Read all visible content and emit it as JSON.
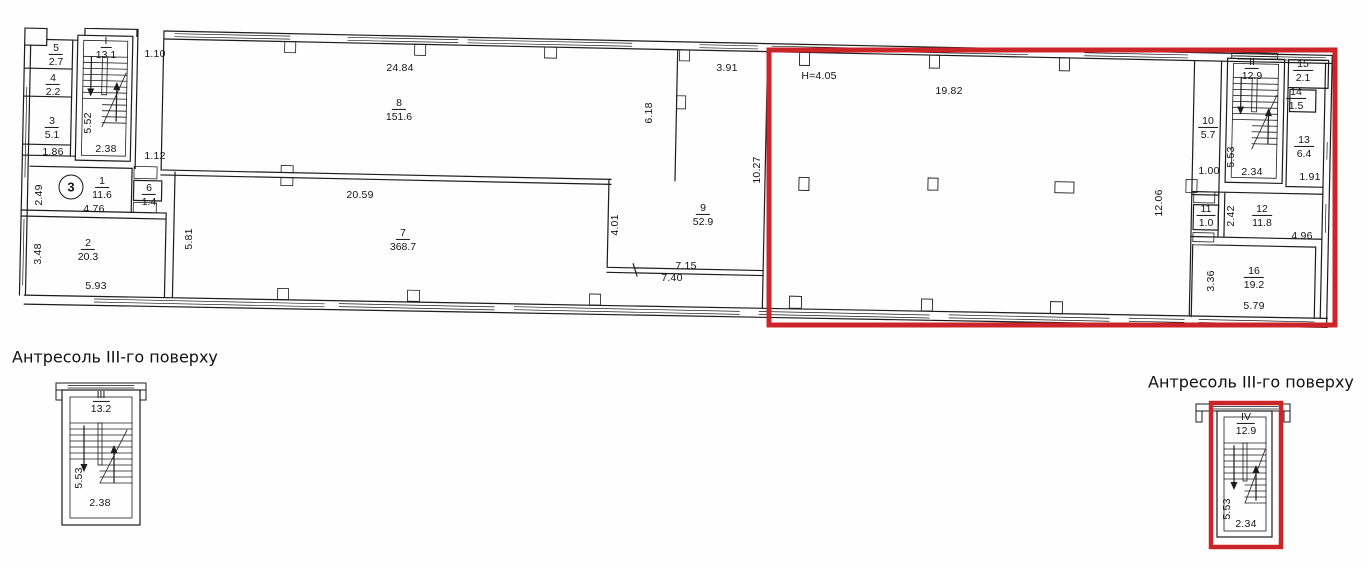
{
  "document": {
    "type": "floor-plan"
  },
  "floor_marker": "3",
  "colors": {
    "highlight_red": "#cc2429",
    "line": "#1c1c1c"
  },
  "rooms": {
    "r1": {
      "num": "1",
      "area": "11.6"
    },
    "r2": {
      "num": "2",
      "area": "20.3"
    },
    "r3": {
      "num": "3",
      "area": "5.1"
    },
    "r4": {
      "num": "4",
      "area": "2.2"
    },
    "r5": {
      "num": "5",
      "area": "2.7"
    },
    "r6": {
      "num": "6",
      "area": "1.4"
    },
    "r7": {
      "num": "7",
      "area": "368.7"
    },
    "r8": {
      "num": "8",
      "area": "151.6"
    },
    "r9": {
      "num": "9",
      "area": "52.9"
    },
    "r10": {
      "num": "10",
      "area": "5.7"
    },
    "r11": {
      "num": "11",
      "area": "1.0"
    },
    "r12": {
      "num": "12",
      "area": "11.8"
    },
    "r13": {
      "num": "13",
      "area": "6.4"
    },
    "r14": {
      "num": "14",
      "area": "1.5"
    },
    "r15": {
      "num": "15",
      "area": "2.1"
    },
    "r16": {
      "num": "16",
      "area": "19.2"
    },
    "s1": {
      "num": "I",
      "area": "13.1"
    },
    "s2": {
      "num": "II",
      "area": "12.9"
    }
  },
  "dims": {
    "block_width": "1.86",
    "stair1_height": "5.52",
    "stair1_width": "2.38",
    "gap_top": "1.10",
    "gap_mid": "1.12",
    "room1_height": "2.49",
    "room1_width": "4.76",
    "room2_height": "3.48",
    "room2_width": "5.93",
    "room7_left_height": "5.81",
    "room8_width": "24.84",
    "room7_width": "20.59",
    "room8_right_height": "6.18",
    "room9_top_width": "3.91",
    "room9_right_height": "10.27",
    "room9_left_height": "4.01",
    "room9_inner_width": "7.15",
    "room9_outer_width": "7.40",
    "hall_height_note": "H=4.05",
    "hall_width": "19.82",
    "hall_depth": "12.06",
    "room10_width": "1.00",
    "stair2_height": "5.53",
    "stair2_width": "2.34",
    "room13_width": "1.91",
    "room12_height": "2.42",
    "room12_width": "4.96",
    "room16_height": "3.36",
    "room16_width": "5.79"
  },
  "mezzanine_left": {
    "title": "Антресоль III-го поверху",
    "stair": {
      "num": "III",
      "area": "13.2"
    },
    "stair_height": "5.53",
    "stair_width": "2.38"
  },
  "mezzanine_right": {
    "title": "Антресоль III-го поверху",
    "stair": {
      "num": "IV",
      "area": "12.9"
    },
    "stair_height": "5.53",
    "stair_width": "2.34"
  }
}
